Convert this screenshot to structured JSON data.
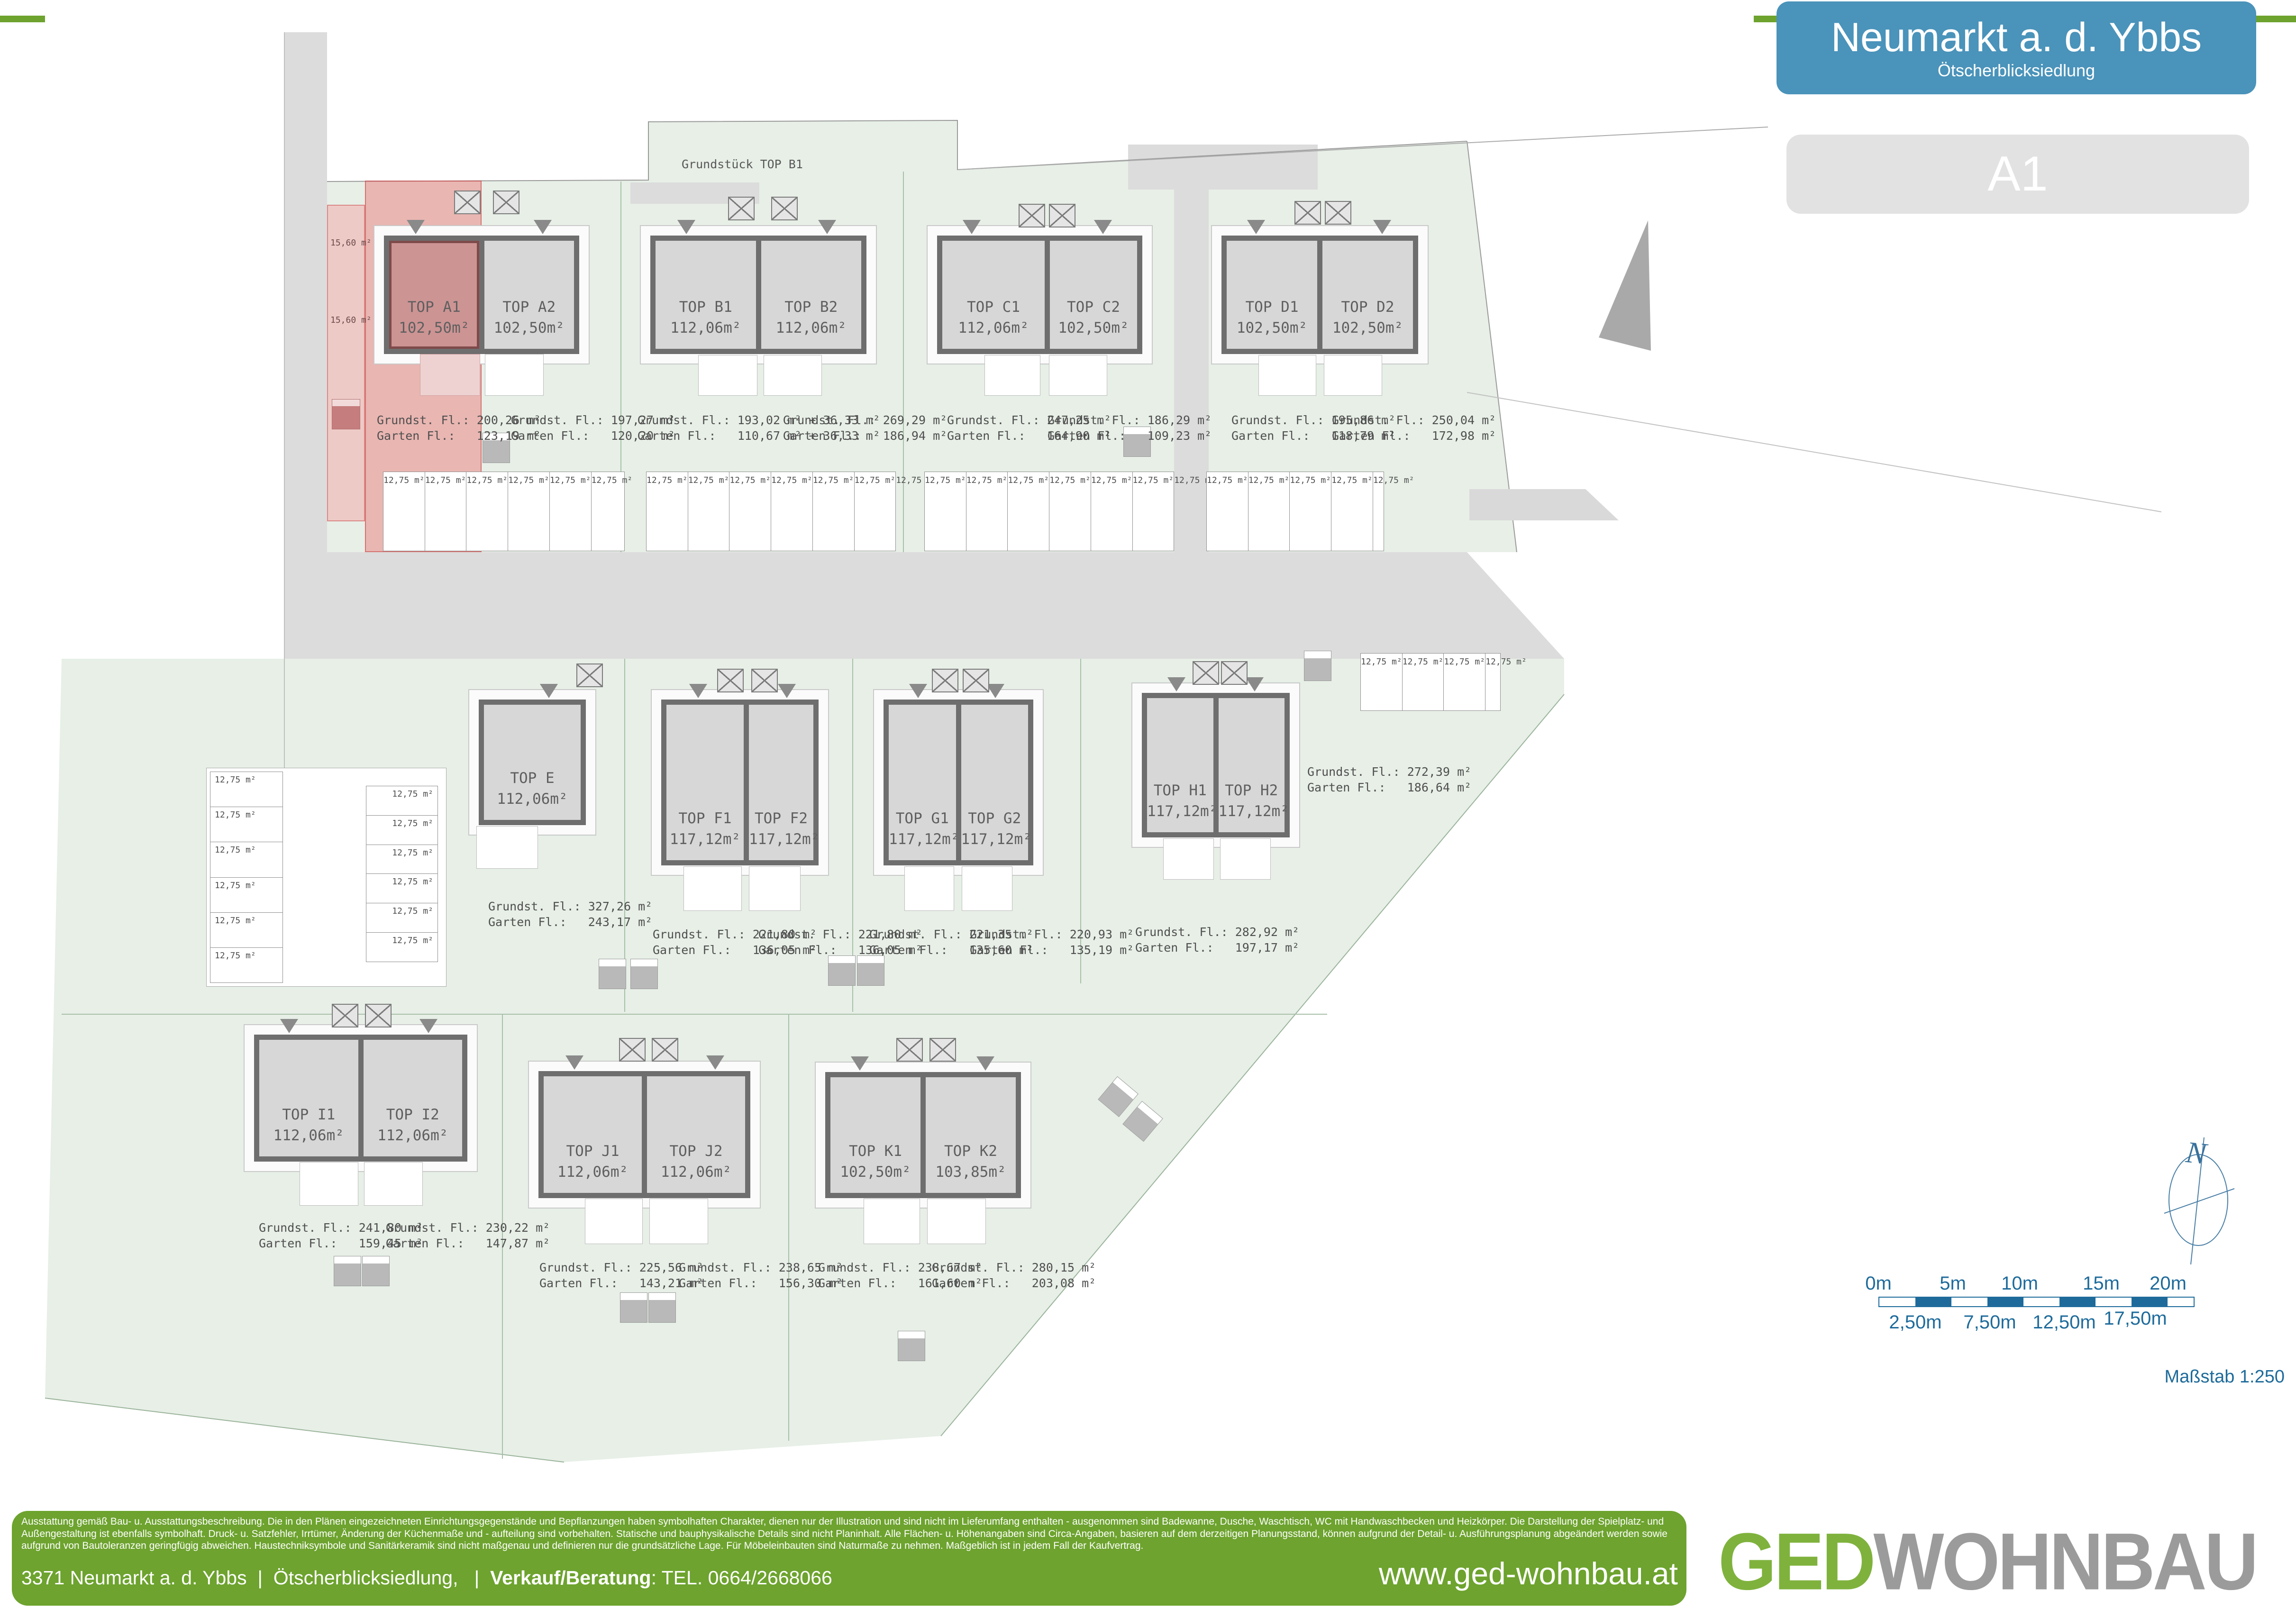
{
  "header": {
    "title": "Neumarkt a. d. Ybbs",
    "subtitle": "Ötscherblicksiedlung",
    "badge": "A1"
  },
  "plan": {
    "note_top": "Grundstück TOP B1",
    "stall_label": "12,75 m²",
    "strip_label_1": "15,60 m²",
    "strip_label_2": "15,60 m²",
    "houses": [
      {
        "id": "A",
        "units": [
          {
            "name": "TOP A1",
            "area": "102,50m²",
            "grundst": "Grundst. Fl.: 200,26 m²",
            "garten": "Garten Fl.:   123,19 m²"
          },
          {
            "name": "TOP A2",
            "area": "102,50m²",
            "grundst": "Grundst. Fl.: 197,27 m²",
            "garten": "Garten Fl.:   120,20 m²"
          }
        ]
      },
      {
        "id": "B",
        "units": [
          {
            "name": "TOP B1",
            "area": "112,06m²",
            "grundst": "Grundst. Fl.: 193,02 m² + 36,33 m²",
            "garten": "Garten Fl.:   110,67 m² + 36,33 m²"
          },
          {
            "name": "TOP B2",
            "area": "112,06m²",
            "grundst": "Grundst. Fl.: 269,29 m²",
            "garten": "Garten Fl.:   186,94 m²"
          }
        ]
      },
      {
        "id": "C",
        "units": [
          {
            "name": "TOP C1",
            "area": "112,06m²",
            "grundst": "Grundst. Fl.: 247,25 m²",
            "garten": "Garten Fl.:   164,90 m²"
          },
          {
            "name": "TOP C2",
            "area": "102,50m²",
            "grundst": "Grundst. Fl.: 186,29 m²",
            "garten": "Garten Fl.:   109,23 m²"
          }
        ]
      },
      {
        "id": "D",
        "units": [
          {
            "name": "TOP D1",
            "area": "102,50m²",
            "grundst": "Grundst. Fl.: 195,86 m²",
            "garten": "Garten Fl.:   118,79 m²"
          },
          {
            "name": "TOP D2",
            "area": "102,50m²",
            "grundst": "Grundst. Fl.: 250,04 m²",
            "garten": "Garten Fl.:   172,98 m²"
          }
        ]
      },
      {
        "id": "E",
        "units": [
          {
            "name": "TOP E",
            "area": "112,06m²",
            "grundst": "Grundst. Fl.: 327,26 m²",
            "garten": "Garten Fl.:   243,17 m²"
          }
        ]
      },
      {
        "id": "F",
        "units": [
          {
            "name": "TOP F1",
            "area": "117,12m²",
            "grundst": "Grundst. Fl.: 221,80 m²",
            "garten": "Garten Fl.:   136,05 m²"
          },
          {
            "name": "TOP F2",
            "area": "117,12m²",
            "grundst": "Grundst. Fl.: 221,80 m²",
            "garten": "Garten Fl.:   136,05 m²"
          }
        ]
      },
      {
        "id": "G",
        "units": [
          {
            "name": "TOP G1",
            "area": "117,12m²",
            "grundst": "Grundst. Fl.: 221,35 m²",
            "garten": "Garten Fl.:   135,60 m²"
          },
          {
            "name": "TOP G2",
            "area": "117,12m²",
            "grundst": "Grundst. Fl.: 220,93 m²",
            "garten": "Garten Fl.:   135,19 m²"
          }
        ]
      },
      {
        "id": "H",
        "units": [
          {
            "name": "TOP H1",
            "area": "117,12m²",
            "grundst": "Grundst. Fl.: 282,92 m²",
            "garten": "Garten Fl.:   197,17 m²"
          },
          {
            "name": "TOP H2",
            "area": "117,12m²",
            "grundst": "Grundst. Fl.: 272,39 m²",
            "garten": "Garten Fl.:   186,64 m²"
          }
        ]
      },
      {
        "id": "I",
        "units": [
          {
            "name": "TOP I1",
            "area": "112,06m²",
            "grundst": "Grundst. Fl.: 241,80 m²",
            "garten": "Garten Fl.:   159,45 m²"
          },
          {
            "name": "TOP I2",
            "area": "112,06m²",
            "grundst": "Grundst. Fl.: 230,22 m²",
            "garten": "Garten Fl.:   147,87 m²"
          }
        ]
      },
      {
        "id": "J",
        "units": [
          {
            "name": "TOP J1",
            "area": "112,06m²",
            "grundst": "Grundst. Fl.: 225,56 m²",
            "garten": "Garten Fl.:   143,21 m²"
          },
          {
            "name": "TOP J2",
            "area": "112,06m²",
            "grundst": "Grundst. Fl.: 238,65 m²",
            "garten": "Garten Fl.:   156,30 m²"
          }
        ]
      },
      {
        "id": "K",
        "units": [
          {
            "name": "TOP K1",
            "area": "102,50m²",
            "grundst": "Grundst. Fl.: 238,67 m²",
            "garten": "Garten Fl.:   161,60 m²"
          },
          {
            "name": "TOP K2",
            "area": "103,85m²",
            "grundst": "Grundst. Fl.: 280,15 m²",
            "garten": "Garten Fl.:   203,08 m²"
          }
        ]
      }
    ]
  },
  "compass": {
    "north": "N"
  },
  "scalebar": {
    "ticks_top": [
      "0m",
      "5m",
      "10m",
      "15m",
      "20m"
    ],
    "ticks_bottom": [
      "2,50m",
      "7,50m",
      "12,50m",
      "17,50m"
    ],
    "caption": "Maßstab 1:250"
  },
  "footer": {
    "disclaimer": "Ausstattung gemäß Bau- u. Ausstattungsbeschreibung. Die in den Plänen eingezeichneten Einrichtungsgegenstände und Bepflanzungen haben symbolhaften Charakter, dienen nur der Illustration und sind nicht im Lieferumfang enthalten - ausgenommen sind Badewanne, Dusche, Waschtisch, WC mit Handwaschbecken und Heizkörper. Die Darstellung der Spielplatz- und Außengestaltung ist ebenfalls symbolhaft. Druck- u. Satzfehler, Irrtümer, Änderung der Küchenmaße und - aufteilung sind vorbehalten. Statische und bauphysikalische Details sind nicht Planinhalt. Alle Flächen- u. Höhenangaben sind Circa-Angaben, basieren auf dem derzeitigen Planungsstand, können aufgrund der Detail- u. Ausführungsplanung abgeändert werden sowie aufgrund von Bautoleranzen geringfügig abweichen. Haustechniksymbole und Sanitärkeramik sind nicht maßgenau und definieren nur die grundsätzliche Lage. Für Möbeleinbauten sind Naturmaße zu nehmen. Maßgeblich ist in jedem Fall der Kaufvertrag.",
    "address": "3371 Neumarkt a. d. Ybbs  |  Ötscherblicksiedlung,   |  ",
    "contact_label": "Verkauf/Beratung",
    "contact_value": ": TEL. 0664/2668066",
    "website": "www.ged-wohnbau.at",
    "logo_part1": "GED",
    "logo_part2": "WOHNBAU"
  }
}
